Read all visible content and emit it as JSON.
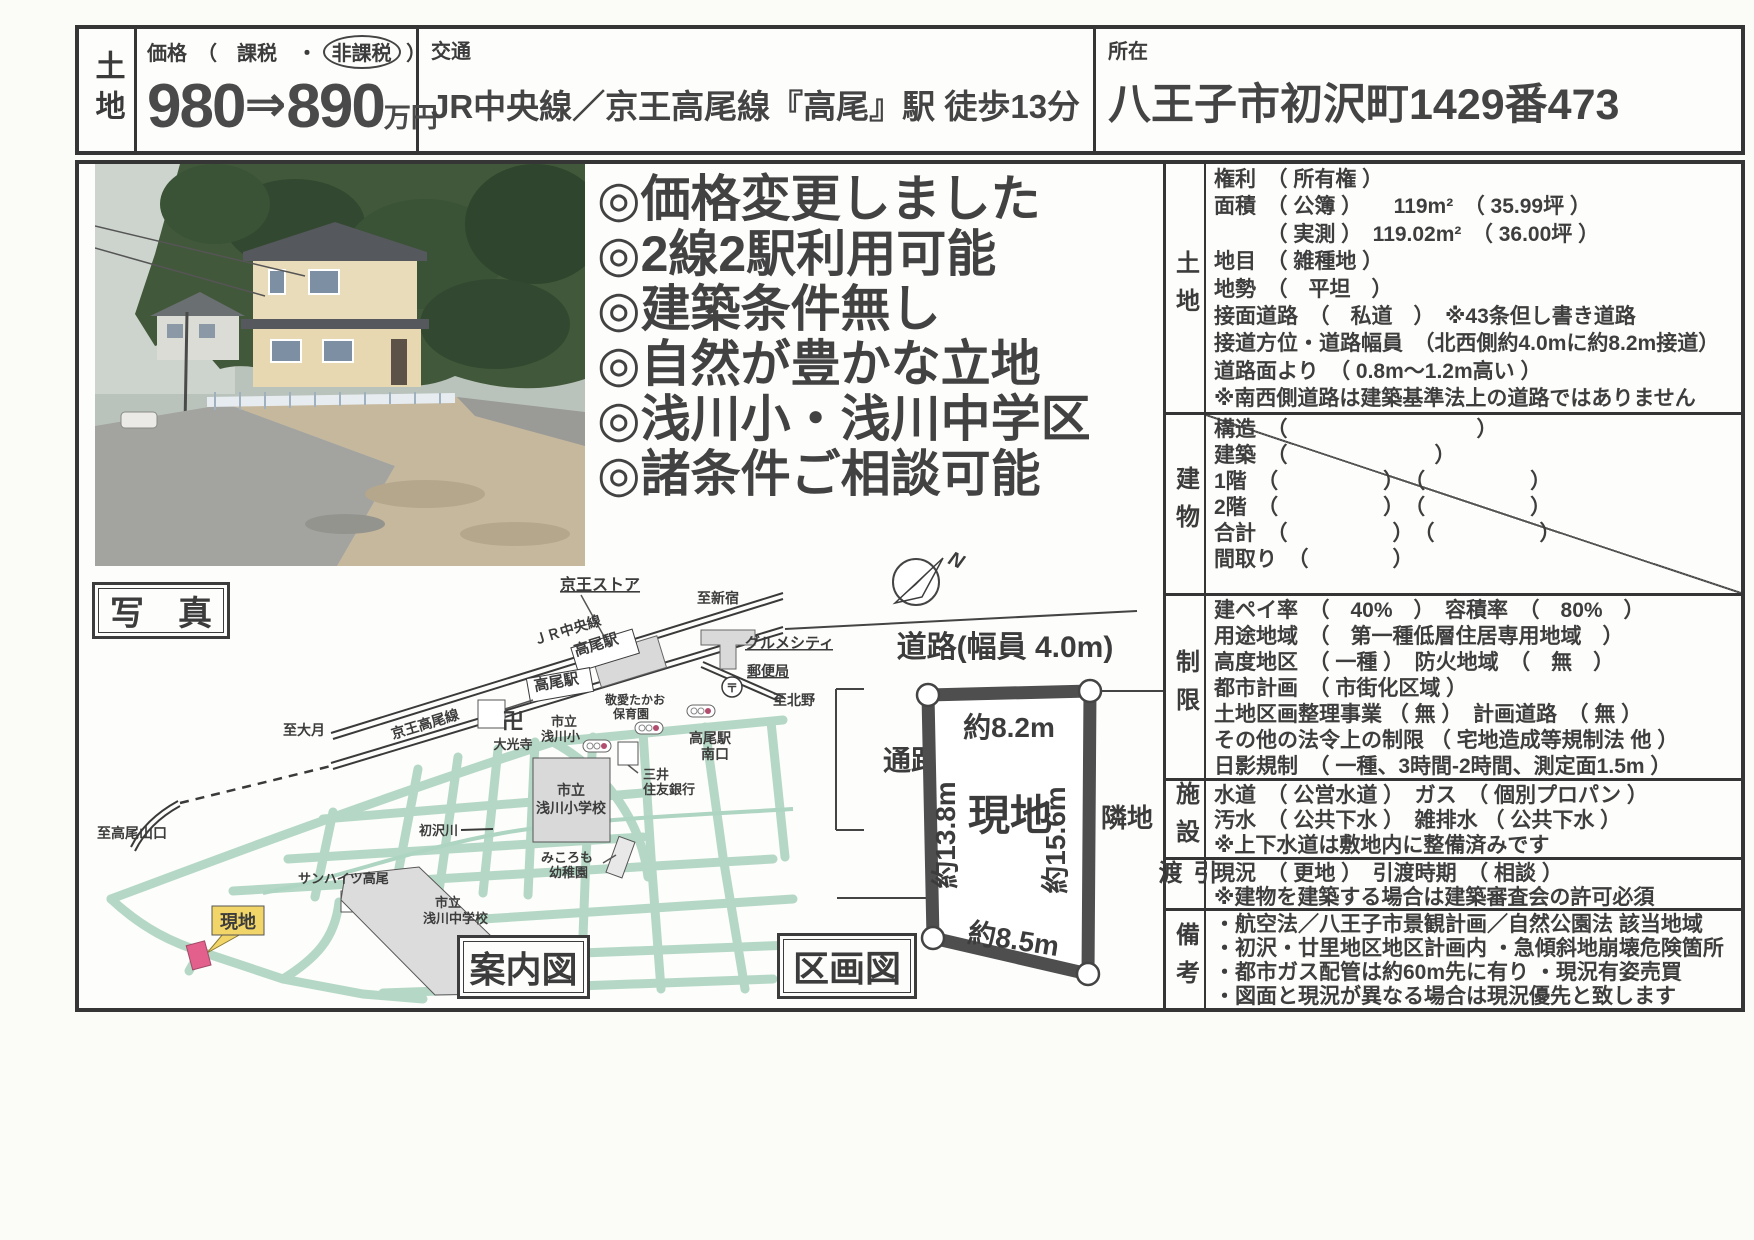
{
  "header": {
    "category": "土地",
    "price_label_pre": "価格　（　課税　・",
    "price_label_taxfree": "非課税",
    "price_label_post": "）",
    "price_old": "980",
    "price_arrow": "⇒",
    "price_new": "890",
    "price_unit": "万円",
    "transit_label": "交通",
    "transit_value": "JR中央線／京王高尾線『高尾』駅 徒歩13分",
    "location_label": "所在",
    "location_value": "八王子市初沢町1429番473"
  },
  "highlights": [
    "◎価格変更しました",
    "◎2線2駅利用可能",
    "◎建築条件無し",
    "◎自然が豊かな立地",
    "◎浅川小・浅川中学区",
    "◎諸条件ご相談可能"
  ],
  "photo_caption": "写　真",
  "map": {
    "caption": "案内図",
    "labels": {
      "keio_store": "京王ストア",
      "to_shinjuku": "至新宿",
      "jr_chuo": "ＪＲ中央線",
      "takao_station_jr": "高尾駅",
      "takao_station_keio": "高尾駅",
      "gourmet_city": "グルメシティ",
      "post_office": "郵便局",
      "post_mark": "〒",
      "to_kitano": "至北野",
      "to_otsuki": "至大月",
      "keio_takao_line": "京王高尾線",
      "manji": "卍",
      "daikoji": "大光寺",
      "keiai_1": "敬愛たかお",
      "keiai_2": "保育園",
      "asakawa_e_1": "市立",
      "asakawa_e_2": "浅川小",
      "takao_south_1": "高尾駅",
      "takao_south_2": "南口",
      "smbc_1": "三井",
      "smbc_2": "住友銀行",
      "asakawa_es_1": "市立",
      "asakawa_es_2": "浅川小学校",
      "mikoromo_1": "みころも",
      "mikoromo_2": "幼稚園",
      "hatsusawa": "初沢川",
      "sunheights": "サンハイツ高尾",
      "asakawa_j_1": "市立",
      "asakawa_j_2": "浅川中学校",
      "to_takaosan": "至高尾山口",
      "site": "現地"
    }
  },
  "plot": {
    "caption": "区画図",
    "north": "N",
    "road": "道路(幅員 4.0m)",
    "top": "約8.2m",
    "left": "約13.8m",
    "right": "約15.6m",
    "bottom": "約8.5m",
    "site": "現地",
    "passage": "通路",
    "neighbor": "隣地"
  },
  "details": {
    "rows": [
      {
        "label": "土地",
        "lines": [
          "権利　（ 所有権 ）",
          "面積　（ 公簿 ）　　119m²　（ 35.99坪 ）",
          "　　　（ 実測 ）　119.02m²　（ 36.00坪 ）",
          "地目　（ 雑種地 ）",
          "地勢　（　平坦　）",
          "接面道路　（　私道　）　※43条但し書き道路",
          "接道方位・道路幅員　（北西側約4.0mに約8.2m接道）",
          "道路面より　（ 0.8m～1.2m高い ）",
          "※南西側道路は建築基準法上の道路ではありません"
        ]
      },
      {
        "label": "建物",
        "lines": [
          "構造　（　　　　　　　　　）",
          "建築　（　　　　　　　）",
          "1階　（　　　　　）　（　　　　　）",
          "2階　（　　　　　）　（　　　　　）",
          "合計　（　　　　　）　（　　　　　）",
          "間取り　（　　　　）"
        ]
      },
      {
        "label": "制限",
        "lines": [
          "建ペイ率　（　40%　）　容積率　（　80%　）",
          "用途地域　（　第一種低層住居専用地域　）",
          "高度地区　（ 一種 ）　防火地域　（　無　）",
          "都市計画　（ 市街化区域 ）",
          "土地区画整理事業 （ 無 ）　計画道路　（ 無 ）",
          "その他の法令上の制限 （ 宅地造成等規制法 他 ）",
          "日影規制　（ 一種、3時間-2時間、測定面1.5m ）"
        ]
      },
      {
        "label": "施設",
        "lines": [
          "水道　（ 公営水道 ）　ガス　（ 個別プロパン ）",
          "汚水　（ 公共下水 ）　雑排水 （ 公共下水 ）",
          "※上下水道は敷地内に整備済みです"
        ]
      },
      {
        "label": "引渡",
        "lines": [
          "現況　（ 更地 ）　引渡時期　（ 相談 ）",
          "※建物を建築する場合は建築審査会の許可必須"
        ]
      },
      {
        "label": "備考",
        "lines": [
          "・航空法／八王子市景観計画／自然公園法 該当地域",
          "・初沢・廿里地区地区計画内 ・急傾斜地崩壊危険箇所",
          "・都市ガス配管は約60m先に有り ・現況有姿売買",
          "・図面と現況が異なる場合は現況優先と致します"
        ]
      }
    ]
  }
}
